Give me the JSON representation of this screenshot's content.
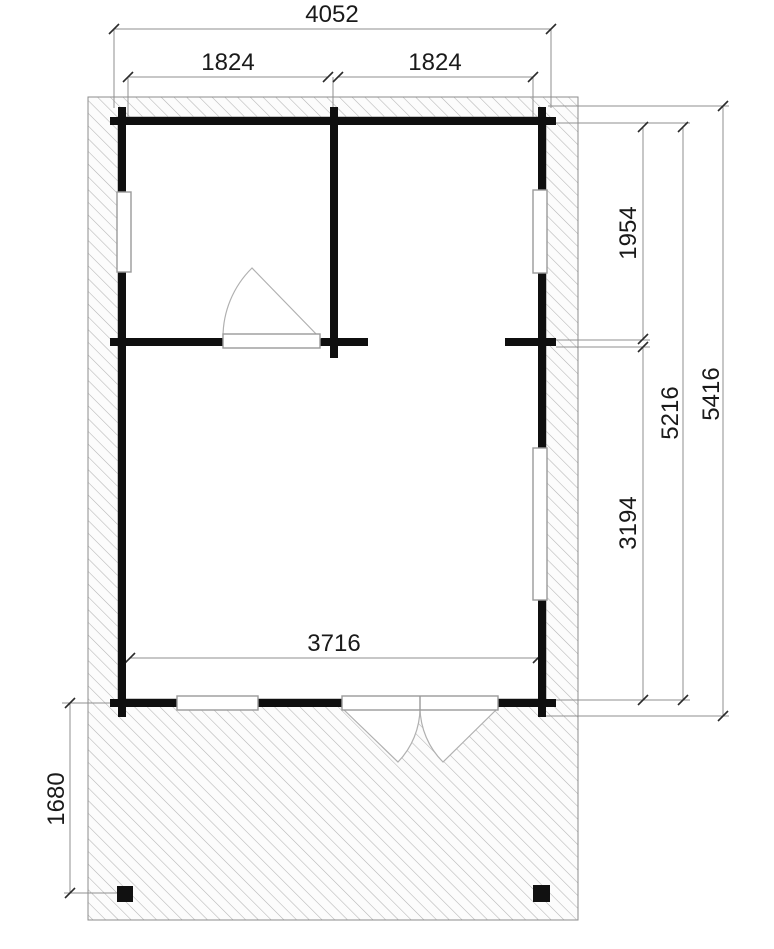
{
  "drawing": {
    "type": "log-cabin-floor-plan-with-terrace",
    "unit_hint": "mm",
    "dims": {
      "overall_width": "4052",
      "left_room_width": "1824",
      "right_room_width": "1824",
      "right_upper_room_depth": "1954",
      "main_room_depth": "3194",
      "inner_depth": "5216",
      "overall_depth": "5416",
      "main_room_width": "3716",
      "terrace_depth": "1680"
    },
    "colors": {
      "background": "#ffffff",
      "wall": "#0f0f0f",
      "hatch_line": "#b4b4b4",
      "hatch_fill": "#fcfcfc",
      "hatch_border": "#8c8c8c",
      "dim_line": "#8f8f8f",
      "tick": "#2b2b2b",
      "label_text": "#1a1a1a",
      "opening_outline": "#9a9a9a",
      "swing_line": "#b0b0b0",
      "post": "#111111"
    }
  }
}
